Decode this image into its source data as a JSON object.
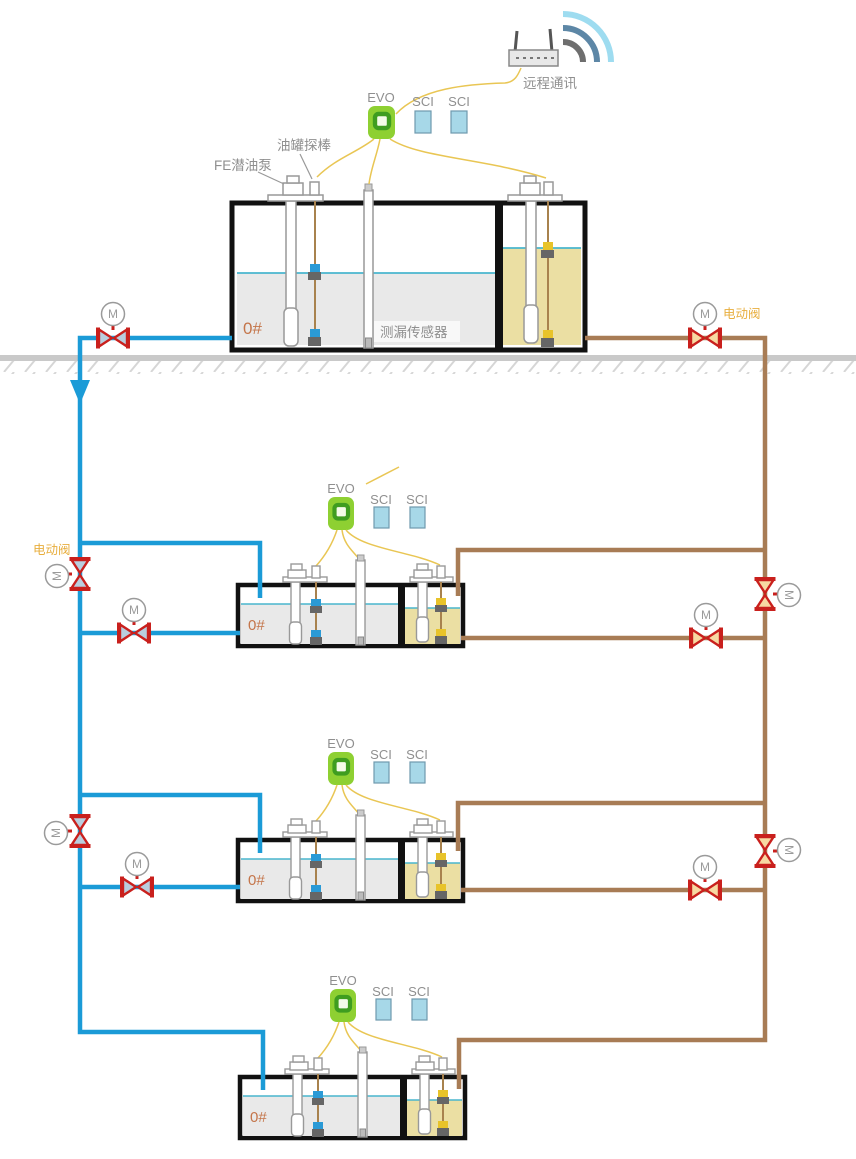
{
  "labels": {
    "remote_communication": "远程通讯",
    "evo": "EVO",
    "sci": "SCI",
    "tank_probe": "油罐探棒",
    "fe_submersible_pump": "FE潜油泵",
    "leak_sensor": "测漏传感器",
    "fuel_grade": "0#",
    "electric_valve": "电动阀",
    "motor": "M"
  },
  "colors": {
    "pipe_blue": "#1b9bd7",
    "pipe_brown": "#a87c55",
    "valve_red": "#c9201d",
    "valve_fill_blue": "#b9cede",
    "valve_fill_tan": "#f7d9a2",
    "liquid_gray": "#e9e9e9",
    "liquid_tan": "#ebdfa3",
    "liquid_surface": "#49b6ce",
    "evo_green": "#8ed032",
    "evo_green_dark": "#3f9d20",
    "sci_fill": "#a7d8e8",
    "wire_yellow": "#e9c654",
    "ground_gray": "#c9c9c9",
    "text_gray": "#8f8f8f",
    "electric_valve_label": "#e8ae3e",
    "fuel_grade_text": "#c4754a",
    "tank_outline": "#111111",
    "equipment_gray": "#999999",
    "float_blue": "#2a9ad6",
    "float_yellow": "#e8c32a",
    "float_dark": "#666666",
    "wifi_outer": "#9edcf0",
    "wifi_mid": "#5d87a6",
    "wifi_inner": "#6e6e6e"
  }
}
